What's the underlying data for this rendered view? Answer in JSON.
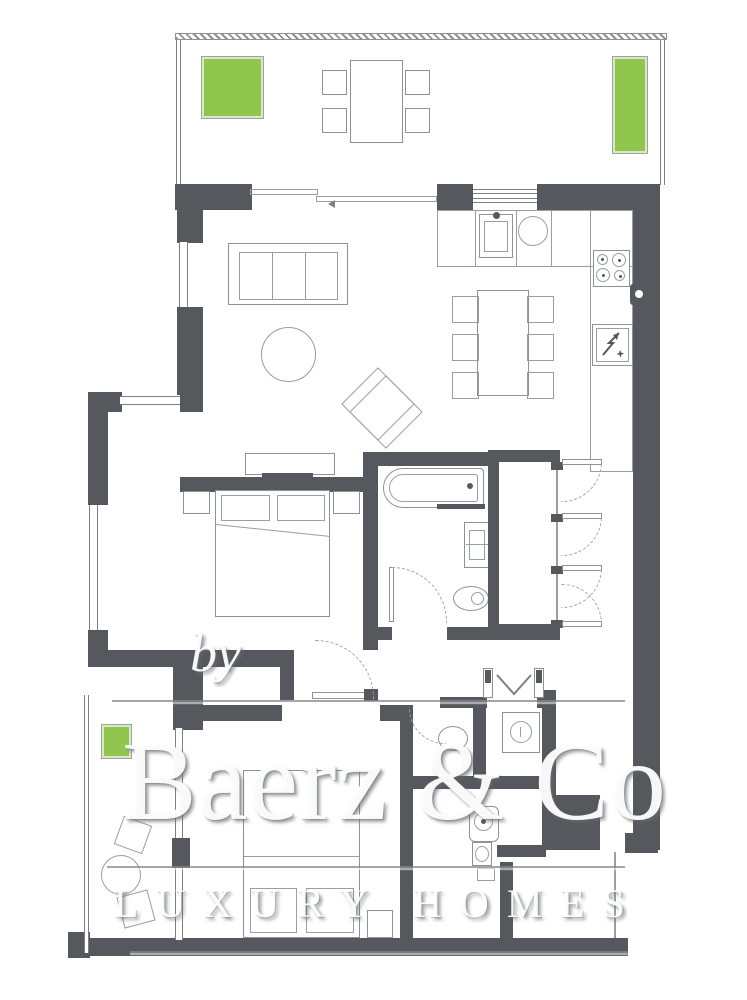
{
  "document": {
    "type": "residential-floor-plan",
    "description": "Two-bedroom apartment floor plan with roof terrace and side balcony"
  },
  "watermark": {
    "prefix": "by",
    "brand": "Baerz & Co",
    "tagline": "LUXURY HOMES"
  },
  "colors": {
    "walls": "#55585d",
    "furniture_outline": "#8e9195",
    "planter_green": "#90c64e",
    "background": "#ffffff",
    "watermark_text": "#ffffff",
    "watermark_shadow": "#84888c"
  },
  "rooms": {
    "terrace": {
      "items": [
        "planter-box",
        "outdoor-dining-table",
        "chair x4",
        "planter-box",
        "sliding-door"
      ]
    },
    "living_room": {
      "items": [
        "sofa-3-seat",
        "coffee-table-round",
        "lounge-chair",
        "sideboard",
        "tv"
      ]
    },
    "kitchen": {
      "items": [
        "sink",
        "round-basin",
        "counter",
        "cooktop-4-burner",
        "freezer",
        "wall-fixture"
      ]
    },
    "dining": {
      "items": [
        "dining-table",
        "chair x6"
      ]
    },
    "bedroom_1": {
      "items": [
        "double-bed",
        "pillow x2",
        "nightstand x2",
        "window"
      ]
    },
    "bathroom": {
      "items": [
        "bathtub",
        "washbasin",
        "toilet",
        "door"
      ]
    },
    "hallway": {
      "items": [
        "wardrobe-4-doors"
      ]
    },
    "entrance": {
      "items": [
        "double-entry-door"
      ]
    },
    "utility": {
      "items": [
        "washing-machine"
      ]
    },
    "guest_wc": {
      "items": [
        "toilet"
      ]
    },
    "shower_room": {
      "items": [
        "toilet",
        "washbasin",
        "drain"
      ]
    },
    "bedroom_2": {
      "items": [
        "double-bed",
        "pillow x2",
        "nightstand",
        "sliding-door"
      ]
    },
    "balcony": {
      "items": [
        "planter-box",
        "chair",
        "round-table",
        "chair"
      ]
    }
  }
}
